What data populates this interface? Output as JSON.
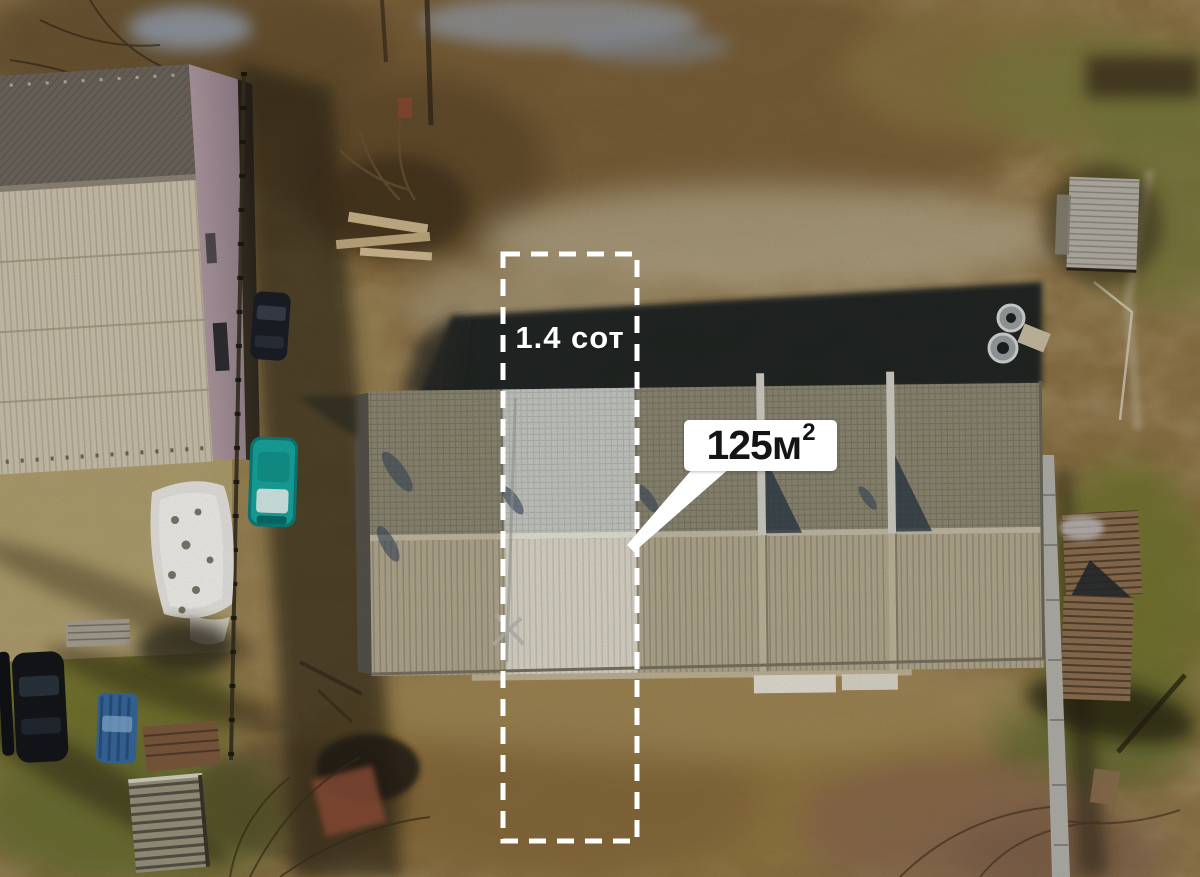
{
  "annotations": {
    "plot_label": "1.4 сот",
    "area_value": "125м",
    "area_superscript": "2"
  },
  "colors": {
    "outline": "#ffffff",
    "callout-bg": "#ffffff",
    "callout-text": "#141414",
    "plot-label-text": "#ffffff",
    "roof-north": "#8f8a74",
    "roof-south": "#b4aa90",
    "roof-north-hl": "#c9ccc6",
    "roof-south-hl": "#ded9cb",
    "neighbor-roof-dark": "#6e675e",
    "neighbor-roof-light": "#cfc5ae",
    "neighbor-wall": "#b09aa2",
    "car-teal": "#18a79e",
    "car-dark": "#1b1f26",
    "car-blue": "#38689e",
    "ground": "#8d7245",
    "grass": "#72752f"
  }
}
